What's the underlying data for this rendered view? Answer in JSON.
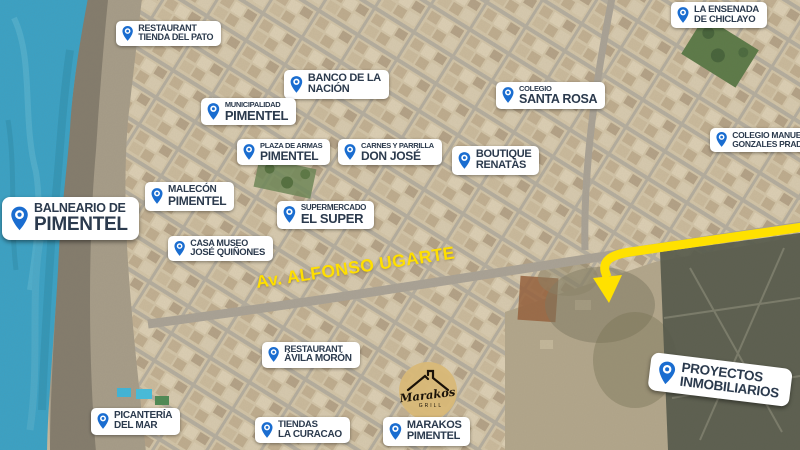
{
  "map_overlay": {
    "road_label": "Av. ALFONSO UGARTE",
    "logo": {
      "name": "Marakos",
      "subtitle": "GRILL"
    },
    "colors": {
      "pin_blue": "#1a6dd0",
      "label_text": "#2b3a4d",
      "road_label_yellow": "#ffdf00",
      "arrow_yellow": "#ffe100",
      "ocean_blue": "#3aa2c6",
      "logo_gold": "#d8b877"
    },
    "markers": [
      {
        "id": "restaurant-tienda-del-pato",
        "line1": "RESTAURANT",
        "line2": "TIENDA DEL PATO",
        "x": 116,
        "y": 21,
        "fs1": 9,
        "fs2": 9,
        "pin": 17
      },
      {
        "id": "la-ensenada-de-chiclayo",
        "line1": "LA ENSENADA",
        "line2": "DE CHICLAYO",
        "x": 671,
        "y": 2,
        "fs1": 9.5,
        "fs2": 9.5,
        "pin": 18
      },
      {
        "id": "banco-de-la-nacion",
        "line1": "BANCO DE LA",
        "line2": "NACIÓN",
        "x": 284,
        "y": 70,
        "fs1": 11,
        "fs2": 11,
        "pin": 19
      },
      {
        "id": "municipalidad-pimentel",
        "line1": "MUNICIPALIDAD",
        "line2": "PIMENTEL",
        "x": 201,
        "y": 98,
        "fs1": 7.5,
        "fs2": 13,
        "pin": 19
      },
      {
        "id": "colegio-santa-rosa",
        "line1": "COLEGIO",
        "line2": "SANTA ROSA",
        "x": 496,
        "y": 82,
        "fs1": 7.5,
        "fs2": 12.5,
        "pin": 18
      },
      {
        "id": "plaza-de-armas-pimentel",
        "line1": "PLAZA DE ARMAS",
        "line2": "PIMENTEL",
        "x": 237,
        "y": 139,
        "fs1": 7.5,
        "fs2": 12,
        "pin": 18
      },
      {
        "id": "carnes-y-parrilla-don-jose",
        "line1": "CARNES Y PARRILLA",
        "line2": "DON JOSÉ",
        "x": 338,
        "y": 139,
        "fs1": 7.5,
        "fs2": 12,
        "pin": 18
      },
      {
        "id": "boutique-renatas",
        "line1": "BOUTIQUE",
        "line2": "RENATÀS",
        "x": 452,
        "y": 146,
        "fs1": 11,
        "fs2": 11,
        "pin": 19
      },
      {
        "id": "colegio-manuel-gonzales-prada",
        "line1": "COLEGIO MANUEL",
        "line2": "GONZALES PRADA",
        "x": 710,
        "y": 128,
        "fs1": 8.5,
        "fs2": 8.5,
        "pin": 17
      },
      {
        "id": "malecon-pimentel",
        "line1": "MALECÓN",
        "line2": "PIMENTEL",
        "x": 145,
        "y": 182,
        "fs1": 10,
        "fs2": 12,
        "pin": 18
      },
      {
        "id": "balneario-de-pimentel",
        "line1": "BALNEARIO DE",
        "line2": "PIMENTEL",
        "x": 2,
        "y": 197,
        "fs1": 12.5,
        "fs2": 19,
        "pin": 27,
        "big": true
      },
      {
        "id": "supermercado-el-super",
        "line1": "SUPERMERCADO",
        "line2": "EL SUPER",
        "x": 277,
        "y": 201,
        "fs1": 8,
        "fs2": 13,
        "pin": 19
      },
      {
        "id": "casa-museo-jose-quinones",
        "line1": "CASA MUSEO",
        "line2": "JOSÉ QUIÑONES",
        "x": 168,
        "y": 236,
        "fs1": 9,
        "fs2": 9.5,
        "pin": 17
      },
      {
        "id": "restaurant-avila-moron",
        "line1": "RESTAURANT",
        "line2": "ÁVILA MORÓN",
        "x": 262,
        "y": 342,
        "fs1": 9,
        "fs2": 10,
        "pin": 17
      },
      {
        "id": "picanteria-del-mar",
        "line1": "PICANTERÍA",
        "line2": "DEL MAR",
        "x": 91,
        "y": 408,
        "fs1": 10,
        "fs2": 10,
        "pin": 18
      },
      {
        "id": "tiendas-la-curacao",
        "line1": "TIENDAS",
        "line2": "LA CURACAO",
        "x": 255,
        "y": 417,
        "fs1": 9.5,
        "fs2": 10,
        "pin": 18
      },
      {
        "id": "marakos-pimentel",
        "line1": "MARAKOS",
        "line2": "PIMENTEL",
        "x": 383,
        "y": 417,
        "fs1": 11,
        "fs2": 11,
        "pin": 19
      },
      {
        "id": "proyectos-inmobiliarios",
        "line1": "PROYECTOS",
        "line2": "INMOBILIARIOS",
        "x": 652,
        "y": 352,
        "fs1": 13.5,
        "fs2": 13.5,
        "pin": 26,
        "rot": 7,
        "big": true
      }
    ]
  }
}
